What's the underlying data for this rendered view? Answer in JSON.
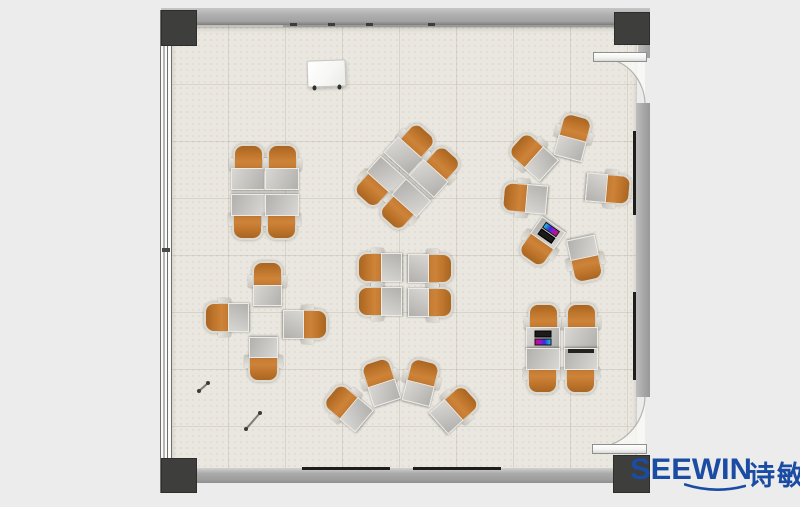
{
  "logo": {
    "brand_en": "SEEWIN",
    "brand_cn": "诗敏",
    "color": "#1b4ca3"
  },
  "palette": {
    "background": "#ececec",
    "floor": "#eae7e0",
    "floor_grid": "#d6d2c7",
    "wall": "#a9a9a9",
    "wall_dark": "#7c7c7c",
    "post": "#3e3e3c",
    "chair_orange": "#cd8338",
    "chair_orange_dark": "#a96521",
    "chair_frame": "#dcd9d1",
    "desk_light": "#d8d7d3",
    "desk_dark": "#b1b0ac",
    "door_leaf": "#ffffff",
    "door_swing_fill": "#faf9f6",
    "laptop_screen": [
      "#e0007f",
      "#3a2bd8",
      "#18c2e8"
    ],
    "accent_blue": "#1b4ca3"
  },
  "fixtures": {
    "whiteboard": {
      "x": 307,
      "y": 60,
      "w": 37,
      "h": 25
    },
    "rail_ticks": [
      290,
      328,
      366,
      428
    ],
    "baseboard_dashes": [
      {
        "x": 302,
        "w": 88
      },
      {
        "x": 413,
        "w": 88
      }
    ],
    "wall_marks": [
      {
        "y": 131,
        "h": 84
      },
      {
        "y": 292,
        "h": 88
      }
    ],
    "pens": [
      {
        "x1": 208,
        "y1": 383,
        "x2": 199,
        "y2": 391
      },
      {
        "x1": 260,
        "y1": 413,
        "x2": 246,
        "y2": 429
      }
    ]
  },
  "furniture": {
    "clusters": [
      {
        "name": "team-table-4-top-left",
        "type": "desk-chair",
        "cx": 265,
        "cy": 191,
        "rot": 0,
        "units": [
          {
            "dx": -17,
            "dy": -22,
            "rot": 0
          },
          {
            "dx": 17,
            "dy": -22,
            "rot": 0
          },
          {
            "dx": -17,
            "dy": 24,
            "rot": 180
          },
          {
            "dx": 17,
            "dy": 24,
            "rot": 180
          }
        ]
      },
      {
        "name": "team-table-4-rotated",
        "type": "desk-chair",
        "cx": 408,
        "cy": 176,
        "rot": 42,
        "units": [
          {
            "dx": -17,
            "dy": -22,
            "rot": 0
          },
          {
            "dx": 17,
            "dy": -22,
            "rot": 0
          },
          {
            "dx": -17,
            "dy": 24,
            "rot": 180
          },
          {
            "dx": 17,
            "dy": 24,
            "rot": 180
          }
        ]
      },
      {
        "name": "team-table-4-bottom-right",
        "type": "desk-chair",
        "cx": 562,
        "cy": 348,
        "rot": 0,
        "units": [
          {
            "dx": -19,
            "dy": -20,
            "rot": 0,
            "accessory": "laptop"
          },
          {
            "dx": 19,
            "dy": -20,
            "rot": 0
          },
          {
            "dx": -19,
            "dy": 21,
            "rot": 180
          },
          {
            "dx": 19,
            "dy": 21,
            "rot": 180,
            "accessory": "dark-tablet"
          }
        ]
      },
      {
        "name": "node-chair-circle",
        "type": "tablet-chair",
        "cx": 565,
        "cy": 198,
        "rot": 0,
        "units": [
          {
            "dx": 7,
            "dy": -59,
            "rot": 15
          },
          {
            "dx": -31,
            "dy": -40,
            "rot": -48
          },
          {
            "dx": -38,
            "dy": 1,
            "rot": -85
          },
          {
            "dx": 41,
            "dy": -10,
            "rot": 95
          },
          {
            "dx": -22,
            "dy": 43,
            "rot": -145,
            "accessory": "laptop"
          },
          {
            "dx": 20,
            "dy": 59,
            "rot": 168
          }
        ]
      },
      {
        "name": "node-chair-pairs-center",
        "type": "tablet-chair",
        "cx": 405,
        "cy": 285,
        "rot": 0,
        "units": [
          {
            "dx": -23,
            "dy": -17,
            "rot": -90
          },
          {
            "dx": 23,
            "dy": -17,
            "rot": 90
          },
          {
            "dx": -23,
            "dy": 17,
            "rot": -90
          },
          {
            "dx": 23,
            "dy": 17,
            "rot": 90
          }
        ]
      },
      {
        "name": "node-chair-pinwheel-left",
        "type": "tablet-chair",
        "cx": 266,
        "cy": 321,
        "rot": 0,
        "units": [
          {
            "dx": 1,
            "dy": -35,
            "rot": 0
          },
          {
            "dx": -37,
            "dy": -3,
            "rot": -90
          },
          {
            "dx": 37,
            "dy": 3,
            "rot": 90
          },
          {
            "dx": -2,
            "dy": 36,
            "rot": 180
          }
        ]
      },
      {
        "name": "node-chair-fan-bottom",
        "type": "tablet-chair",
        "cx": 400,
        "cy": 396,
        "rot": 0,
        "units": [
          {
            "dx": -51,
            "dy": 13,
            "rot": -50
          },
          {
            "dx": -19,
            "dy": -12,
            "rot": -18
          },
          {
            "dx": 20,
            "dy": -12,
            "rot": 14
          },
          {
            "dx": 53,
            "dy": 14,
            "rot": 48
          }
        ]
      }
    ]
  }
}
